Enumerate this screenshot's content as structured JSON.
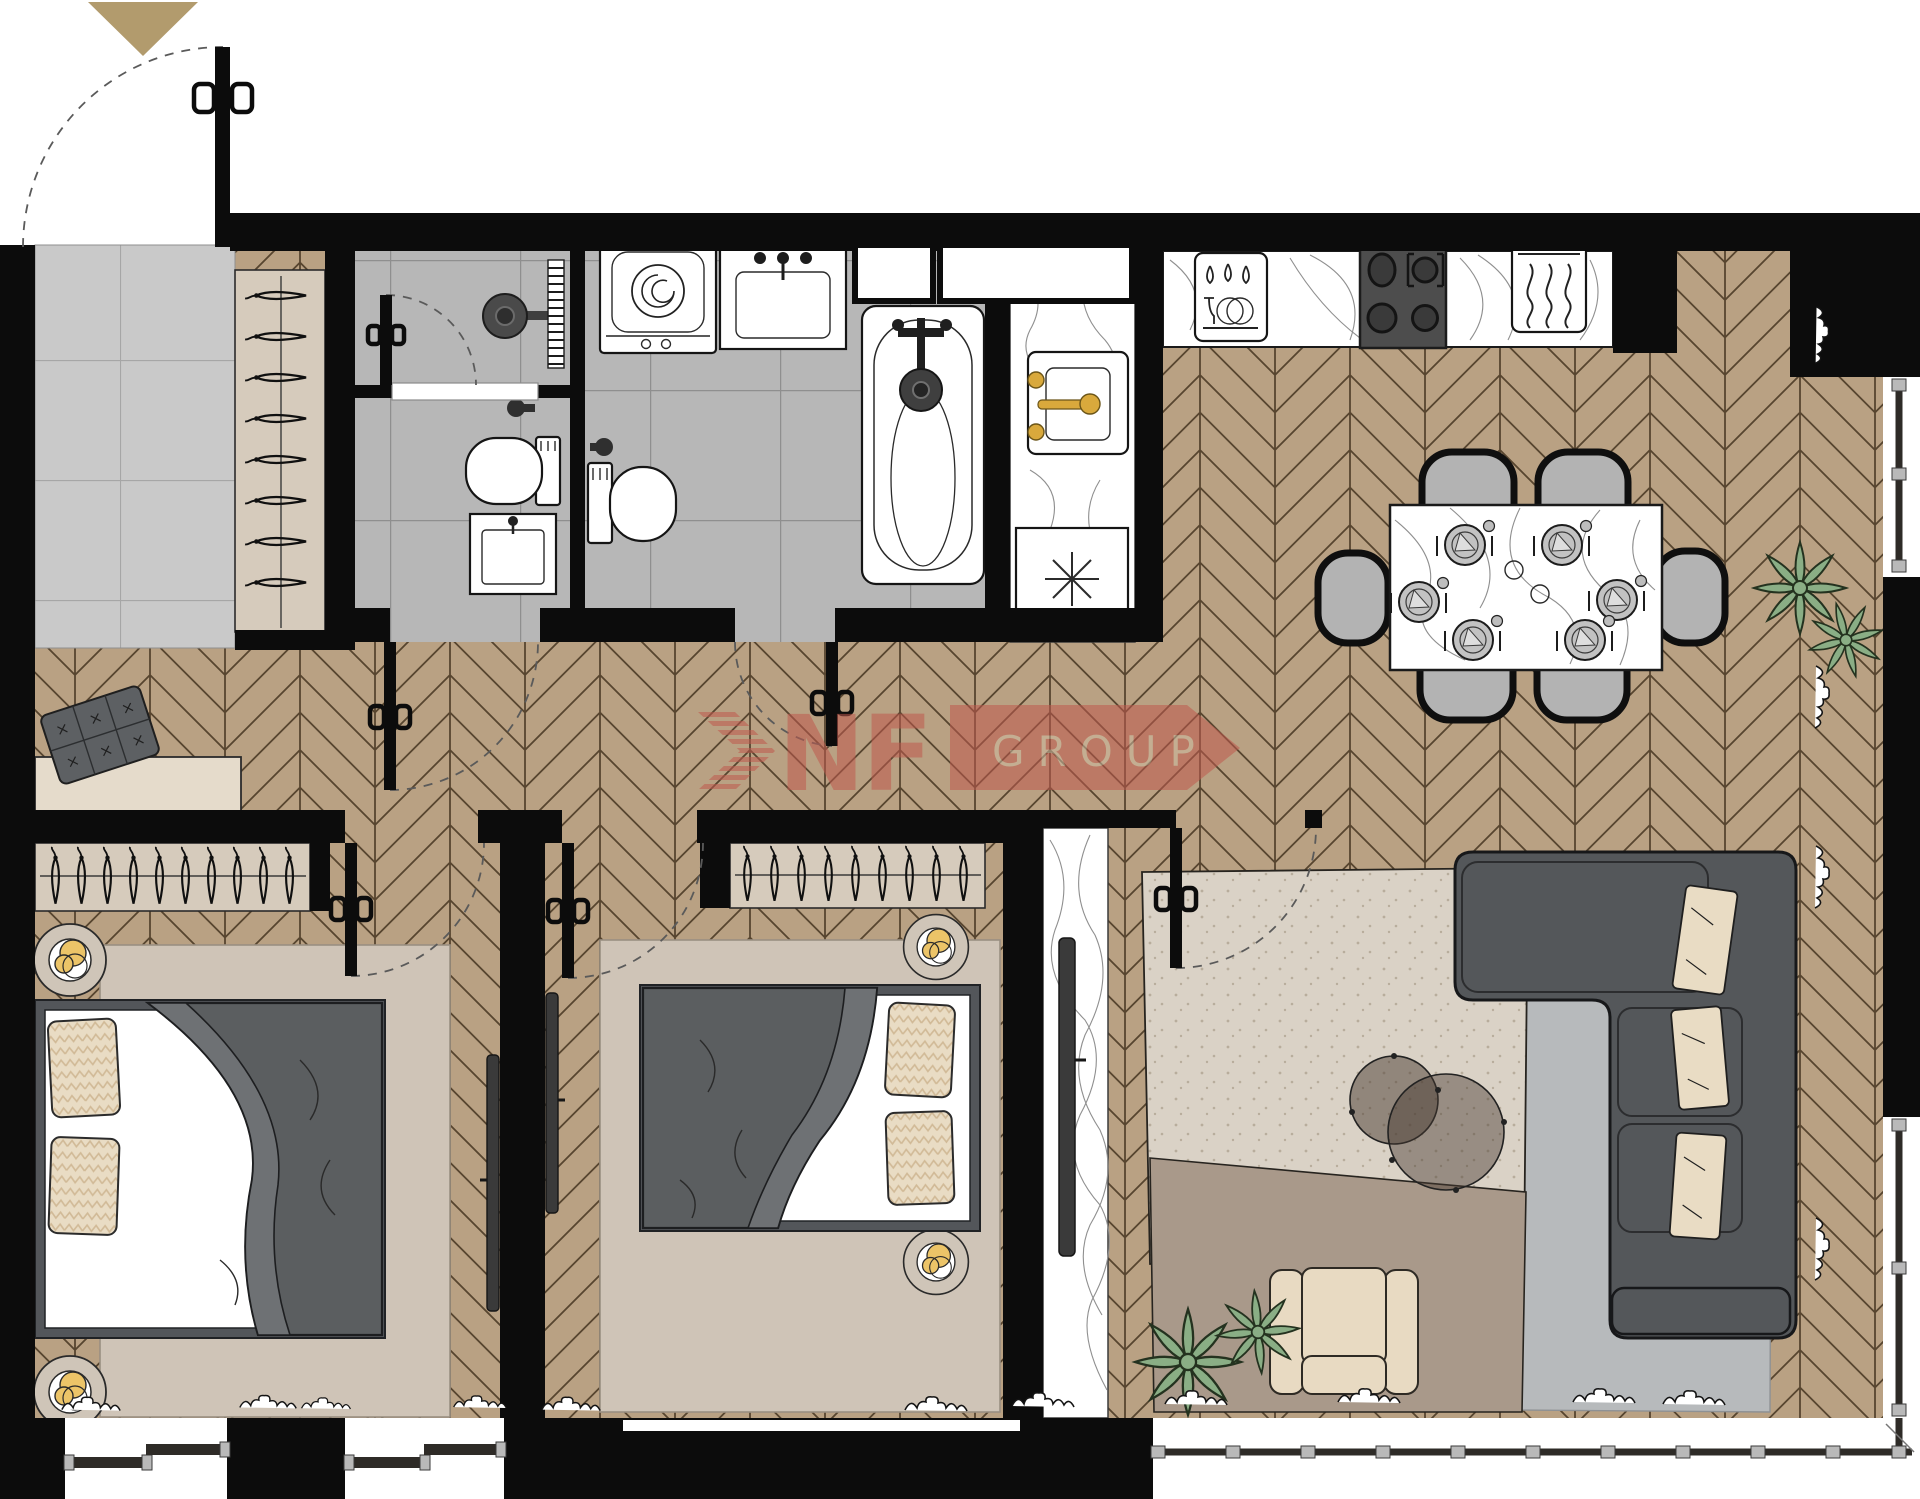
{
  "watermark": {
    "letters": "NF",
    "box_label": "GROUP",
    "letters_color": "#c05a4e",
    "box_color": "#c05a4e",
    "box_text_color": "#cdbaa0",
    "opacity": 0.55
  },
  "entrance_arrow_color": "#b29b6d",
  "palette": {
    "wall": "#0c0c0c",
    "floor_wood": "#b9a183",
    "floor_wood_line": "#57452f",
    "bath_tile": "#b7b7b7",
    "entry_tile": "#c9c9c9",
    "closet_wood": "#d6cbbc",
    "rug_bedroom": "#cfc4b7",
    "rug_living_beige": "#dad2c6",
    "rug_living_brown": "#a9998a",
    "rug_living_gray": "#b7babc",
    "sofa_gray": "#54575a",
    "duvet_gray": "#5b5e60",
    "pillow_beige": "#e9dcc4",
    "lamp_gold": "#ecc468",
    "gold_fixture": "#d9a93c",
    "plant_green": "#8aae85",
    "chair_gray": "#b3b3b3",
    "armchair_beige": "#e8dac2",
    "window_frame": "#2e2b27",
    "window_mullion": "#b9b9b9",
    "cooktop_dark": "#4d4d4d"
  },
  "counts": {
    "dining_chairs": 6,
    "dining_place_settings": 6,
    "entry_closet_hangers": 8,
    "bedroom1_hangers": 10,
    "bedroom2_hangers": 9,
    "bed_pillows_per_bed": 2,
    "sofa_pillows": 3,
    "coffee_tables": 2,
    "plant_clusters": 4,
    "bedroom_windows": 2,
    "right_side_windows": 2,
    "panoramic_bottom_window": 1
  },
  "rooms": [
    "entry-hall",
    "shower-room",
    "bathroom",
    "utility-niche",
    "corridor",
    "kitchen",
    "dining-area",
    "living-room",
    "bedroom-1",
    "bedroom-2"
  ]
}
